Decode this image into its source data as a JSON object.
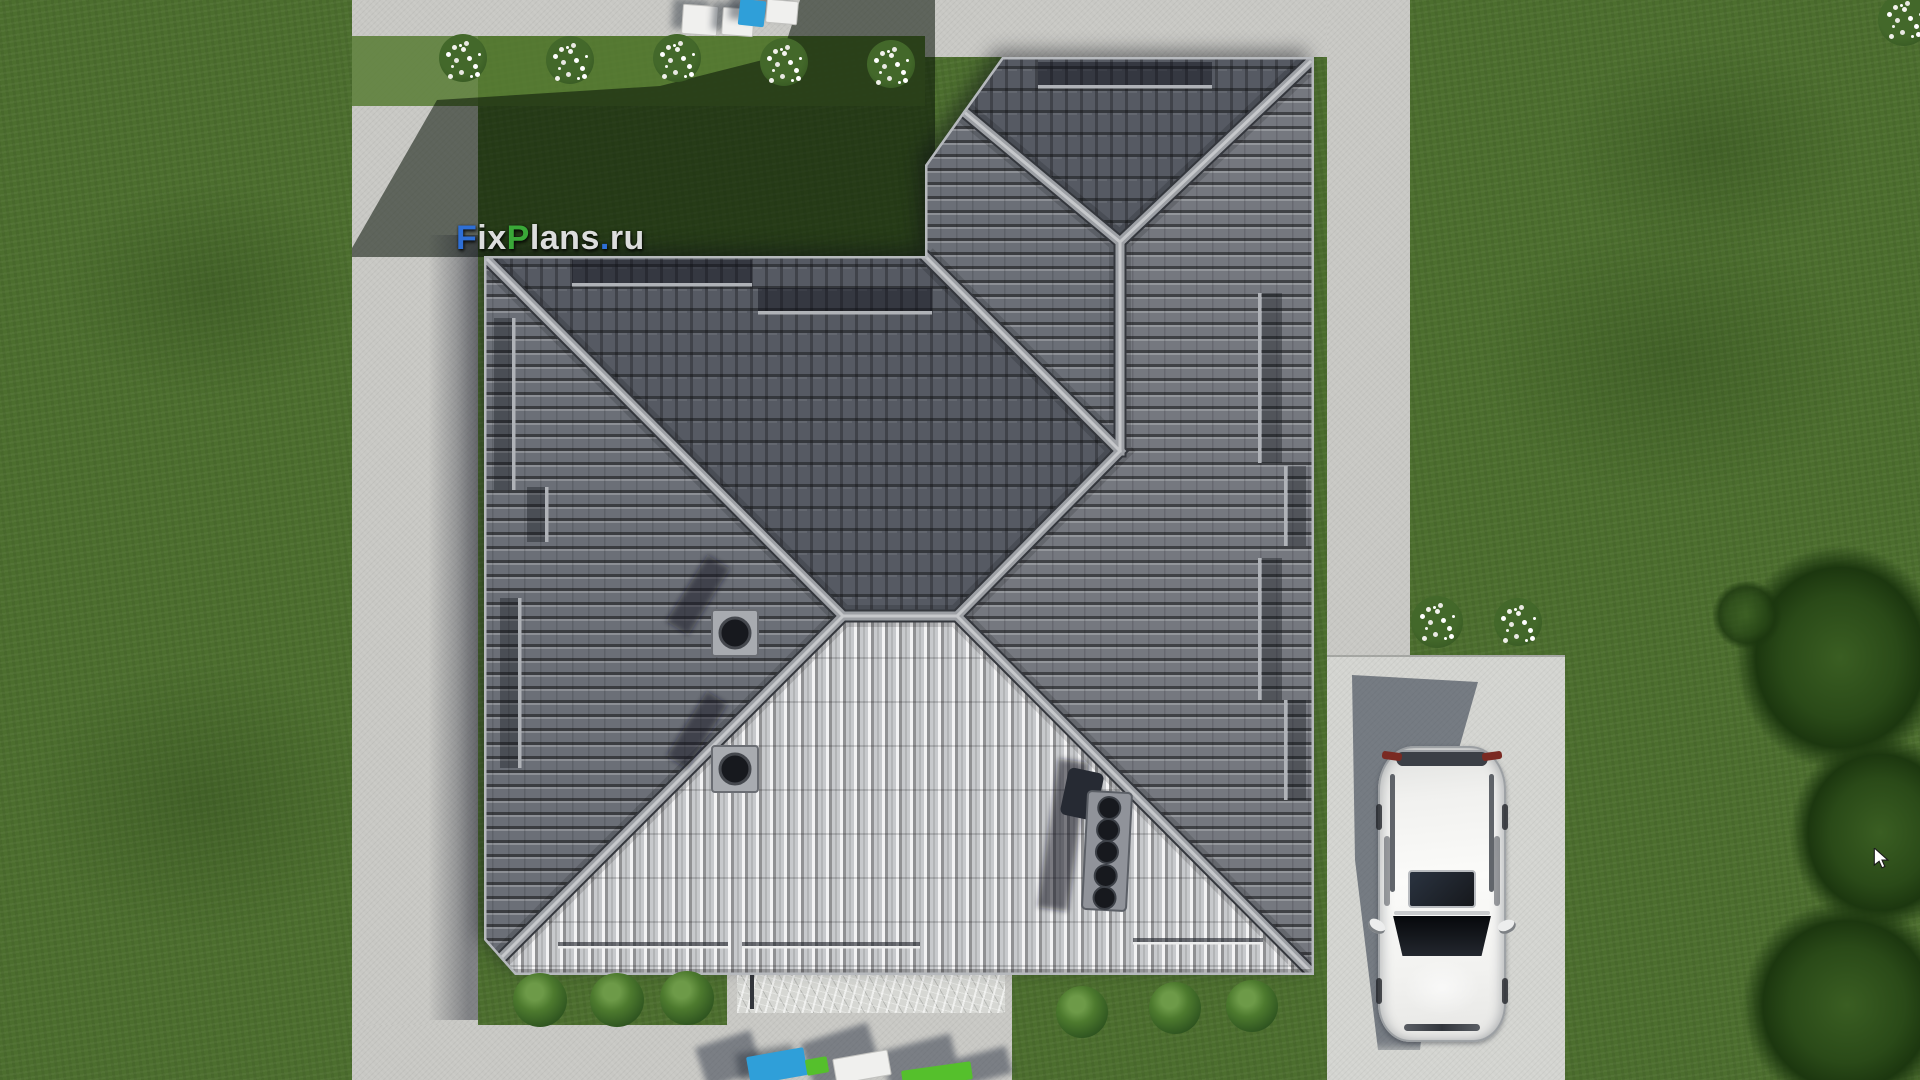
{
  "watermark": {
    "text": "FixPlans.ru",
    "segments": [
      {
        "text": "F",
        "color": "#2e6fd6"
      },
      {
        "text": "ix",
        "color": "#dcdddd"
      },
      {
        "text": "P",
        "color": "#3aa838"
      },
      {
        "text": "lans",
        "color": "#dcdddd"
      },
      {
        "text": ".",
        "color": "#2e6fd6"
      },
      {
        "text": "ru",
        "color": "#dcdddd"
      }
    ]
  },
  "palette": {
    "grass_base": "#4c6e2e",
    "grass_bright": "#577b33",
    "grass_shadow": "rgba(8,18,6,0.55)",
    "concrete": "#c8c8c4",
    "concrete_bright": "#d3d4d0",
    "roof_north": "#565a63",
    "roof_west": "#6b6f77",
    "roof_east": "#75787f",
    "roof_south": "#c7c9cc",
    "roof_ridge": "#9da0a5",
    "roof_eave": "#b6b9bd",
    "car_body": "#f2f2f0",
    "car_glass": "#16181c",
    "logo_blue": "#2e6fd6",
    "logo_green": "#3aa838",
    "logo_white": "#dcdddd",
    "furniture_blue": "#2f9fd9",
    "furniture_green": "#55c02c",
    "flower_white": "#f2f2ec",
    "shrub_green": "#48762c",
    "tree_dark": "#2a4a18",
    "vent_dark": "#17191e"
  },
  "scene": {
    "view": "top-down aerial 3D render",
    "subject": "single-family house with dark hip tile roof, lawn, concrete walkways, driveway and parked white SUV",
    "objects": [
      "hip-tile-roof",
      "roof-ridges",
      "snow-guard-rails",
      "round-roof-vents",
      "vent-strip",
      "lawn",
      "concrete-path-left",
      "concrete-path-top",
      "concrete-path-right",
      "driveway-pad",
      "entrance-walkway",
      "stone-paving-strip",
      "white-suv-car",
      "car-shadow",
      "house-shadow",
      "white-flower-bushes",
      "green-shrubs",
      "dark-trees",
      "garden-furniture-top",
      "garden-furniture-bottom",
      "mouse-cursor"
    ]
  }
}
